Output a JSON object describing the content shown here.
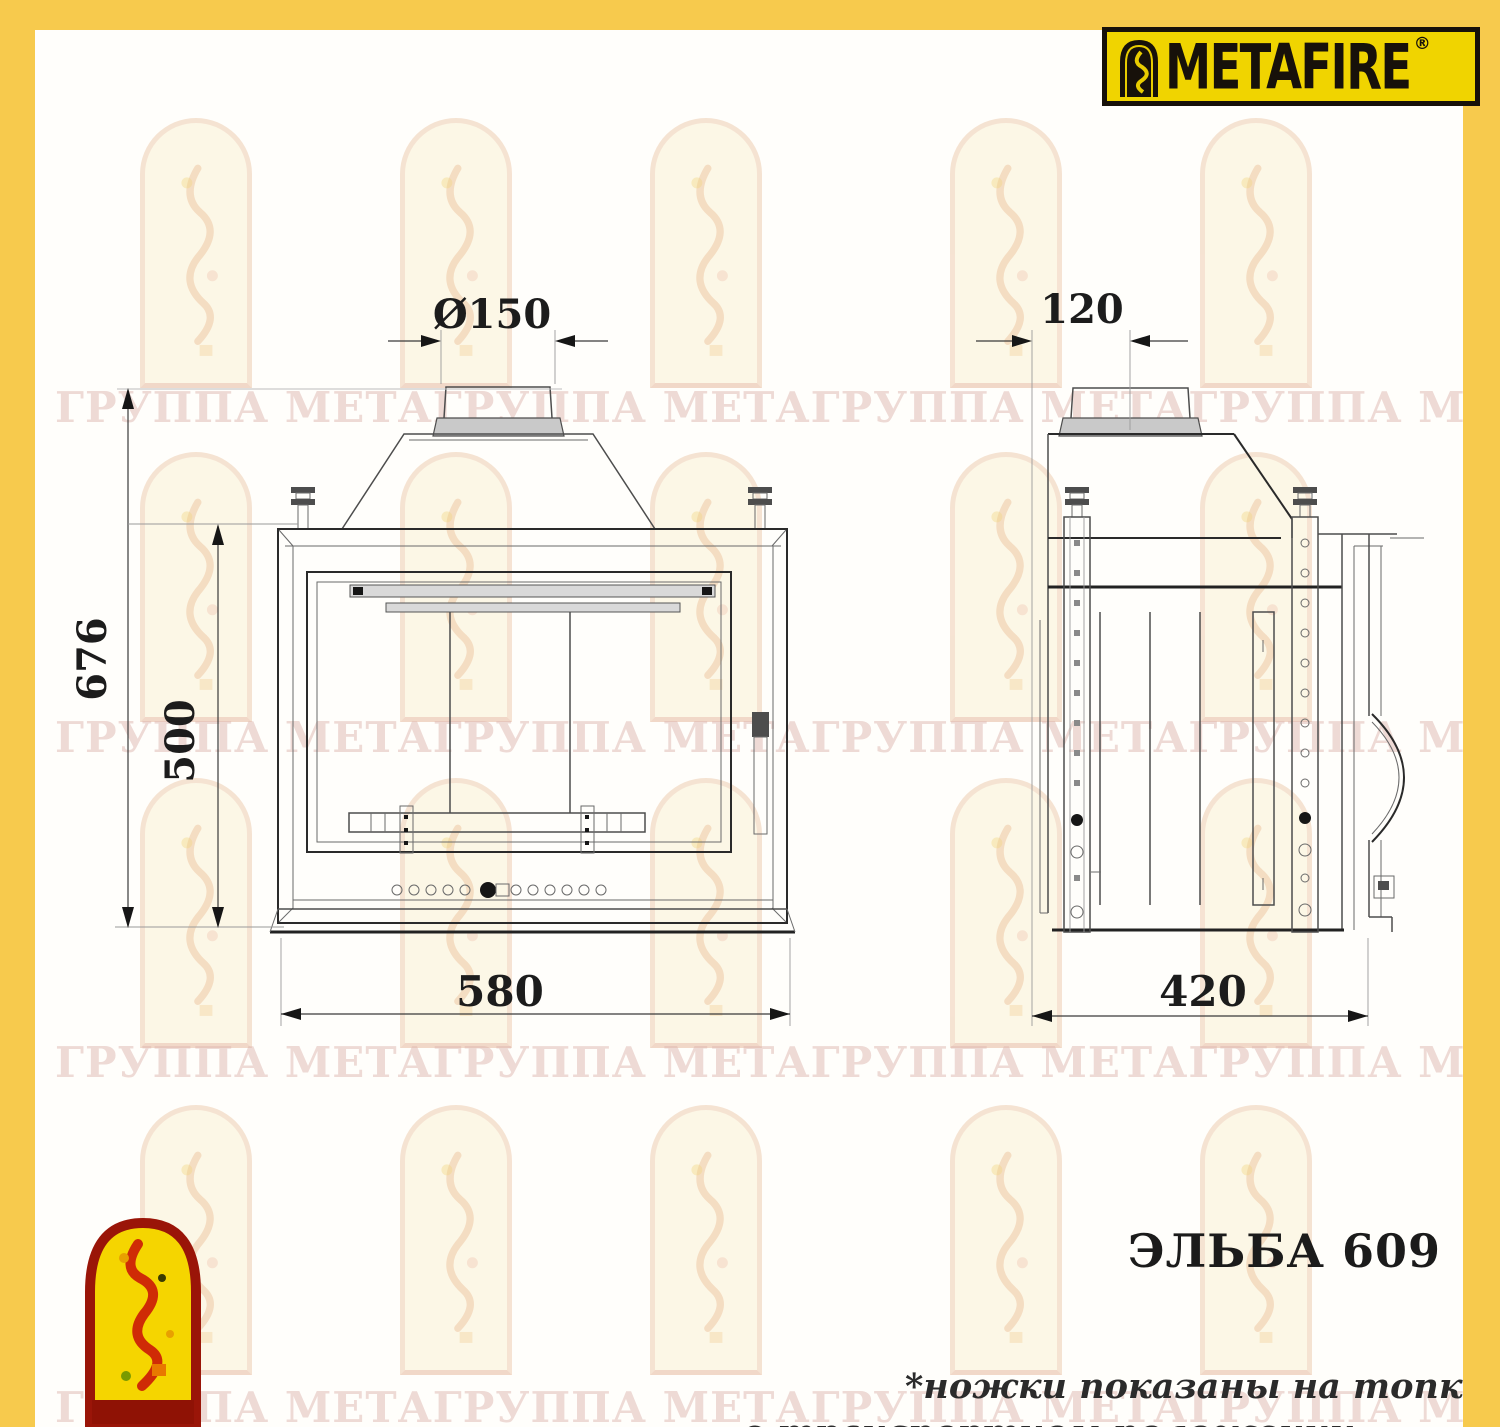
{
  "page": {
    "background_color": "#FFFEFB",
    "frame_color": "#F7CA4D"
  },
  "brand_logo": {
    "text": "METAFIRE",
    "registered_mark": "®",
    "bg_color": "#F0D400",
    "text_color": "#17110A",
    "icon": "arch-flame-icon"
  },
  "watermark": {
    "row_text": "ГРУППА МЕТАГРУППА МЕТАГРУППА МЕТАГРУППА МЕТАГРУППА МЕТА",
    "color": "#E3BDB5",
    "arch_icon": "arch-figure-watermark"
  },
  "drawing": {
    "front_view": {
      "title": "front-view-of-fireplace-insert",
      "dims": {
        "flue_diameter": "Ø150",
        "overall_height": "676",
        "door_height": "500",
        "width": "580"
      }
    },
    "side_view": {
      "title": "side-view-of-fireplace-insert",
      "dims": {
        "flue_center_offset": "120",
        "depth": "420"
      }
    }
  },
  "product": {
    "model": "ЭЛЬБА 609"
  },
  "footnote": {
    "line1": "*ножки показаны на топке",
    "line2": "в транспортном положении"
  }
}
